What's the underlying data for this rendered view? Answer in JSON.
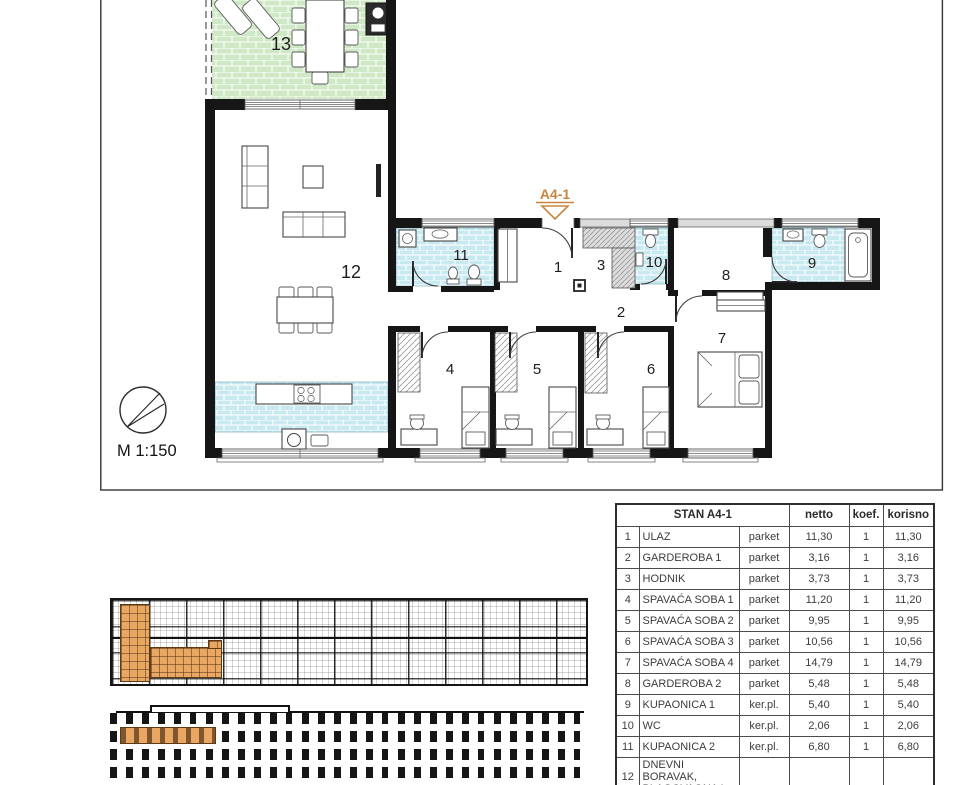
{
  "sheet": {
    "marker": "A4-1",
    "scale": "M 1:150",
    "rooms": {
      "r1": "1",
      "r2": "2",
      "r3": "3",
      "r4": "4",
      "r5": "5",
      "r6": "6",
      "r7": "7",
      "r8": "8",
      "r9": "9",
      "r10": "10",
      "r11": "11",
      "r12": "12",
      "r13": "13"
    }
  },
  "legend_table": {
    "title": "STAN A4-1",
    "columns": {
      "netto": "netto",
      "koef": "koef.",
      "korisno": "korisno"
    },
    "rows": [
      {
        "num": "1",
        "name": "ULAZ",
        "floor": "parket",
        "netto": "11,30",
        "koef": "1",
        "korisno": "11,30"
      },
      {
        "num": "2",
        "name": "GARDEROBA 1",
        "floor": "parket",
        "netto": "3,16",
        "koef": "1",
        "korisno": "3,16"
      },
      {
        "num": "3",
        "name": "HODNIK",
        "floor": "parket",
        "netto": "3,73",
        "koef": "1",
        "korisno": "3,73"
      },
      {
        "num": "4",
        "name": "SPAVAĆA SOBA 1",
        "floor": "parket",
        "netto": "11,20",
        "koef": "1",
        "korisno": "11,20"
      },
      {
        "num": "5",
        "name": "SPAVAĆA SOBA 2",
        "floor": "parket",
        "netto": "9,95",
        "koef": "1",
        "korisno": "9,95"
      },
      {
        "num": "6",
        "name": "SPAVAĆA SOBA 3",
        "floor": "parket",
        "netto": "10,56",
        "koef": "1",
        "korisno": "10,56"
      },
      {
        "num": "7",
        "name": "SPAVAĆA SOBA 4",
        "floor": "parket",
        "netto": "14,79",
        "koef": "1",
        "korisno": "14,79"
      },
      {
        "num": "8",
        "name": "GARDEROBA 2",
        "floor": "parket",
        "netto": "5,48",
        "koef": "1",
        "korisno": "5,48"
      },
      {
        "num": "9",
        "name": "KUPAONICA 1",
        "floor": "ker.pl.",
        "netto": "5,40",
        "koef": "1",
        "korisno": "5,40"
      },
      {
        "num": "10",
        "name": "WC",
        "floor": "ker.pl.",
        "netto": "2,06",
        "koef": "1",
        "korisno": "2,06"
      },
      {
        "num": "11",
        "name": "KUPAONICA 2",
        "floor": "ker.pl.",
        "netto": "6,80",
        "koef": "1",
        "korisno": "6,80"
      },
      {
        "num": "12",
        "name": "DNEVNI BORAVAK, BLAGOVAONA I",
        "floor": "",
        "netto": "",
        "koef": "",
        "korisno": ""
      }
    ]
  },
  "colors": {
    "tile_blue": "#c9e9f1",
    "terrace_green": "#cfe8c5",
    "unit_highlight": "#eaa763",
    "marker_orange": "#c9853f"
  }
}
